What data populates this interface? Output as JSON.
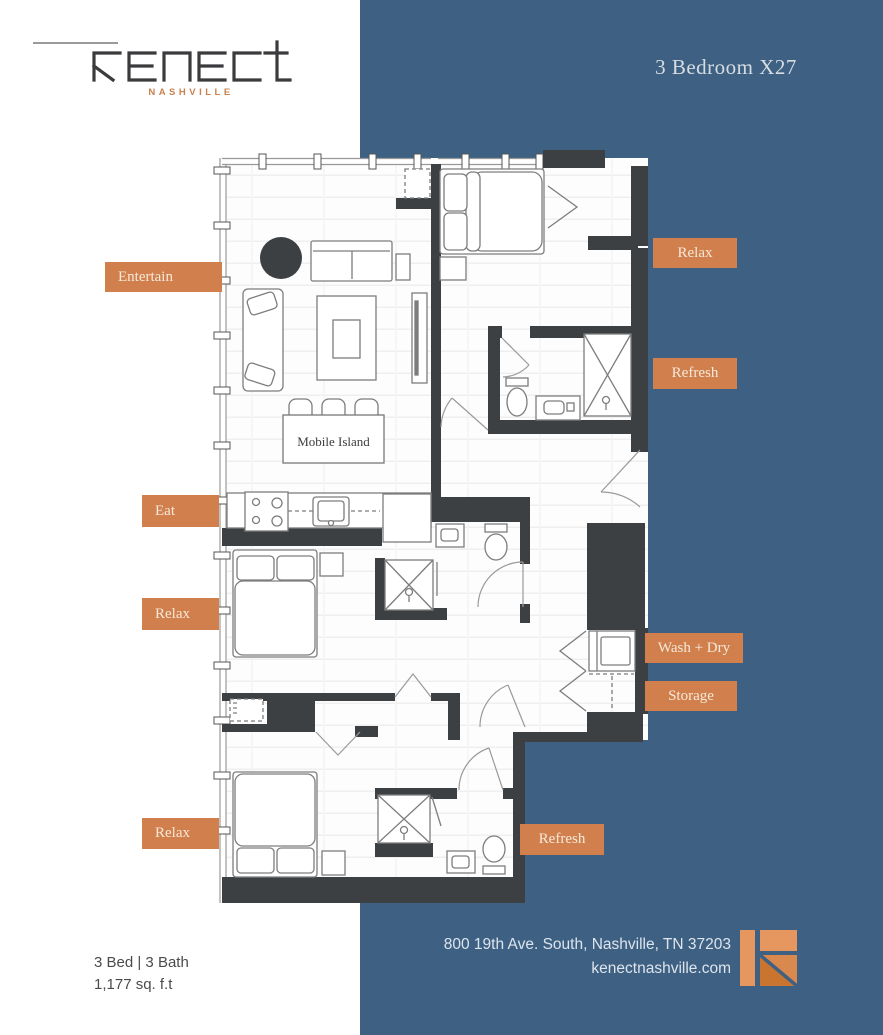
{
  "brand": {
    "name": "kenect",
    "city": "NASHVILLE"
  },
  "header": {
    "title": "3 Bedroom X27"
  },
  "floorplan": {
    "island_label": "Mobile Island",
    "labels": [
      {
        "id": "entertain",
        "text": "Entertain"
      },
      {
        "id": "eat",
        "text": "Eat"
      },
      {
        "id": "relax-mid",
        "text": "Relax"
      },
      {
        "id": "relax-bottom",
        "text": "Relax"
      },
      {
        "id": "relax-right",
        "text": "Relax"
      },
      {
        "id": "refresh-right",
        "text": "Refresh"
      },
      {
        "id": "wash-dry",
        "text": "Wash + Dry"
      },
      {
        "id": "storage",
        "text": "Storage"
      },
      {
        "id": "refresh-bottom",
        "text": "Refresh"
      }
    ]
  },
  "footer": {
    "left": {
      "beds_baths": "3 Bed | 3 Bath",
      "area": "1,177 sq. f.t"
    },
    "right": {
      "address": "800 19th Ave. South, Nashville, TN 37203",
      "website": "kenectnashville.com"
    }
  },
  "colors": {
    "blue": "#3e6183",
    "orange": "#d1804d",
    "wall": "#3d4043",
    "cream": "#f5e9d9"
  }
}
